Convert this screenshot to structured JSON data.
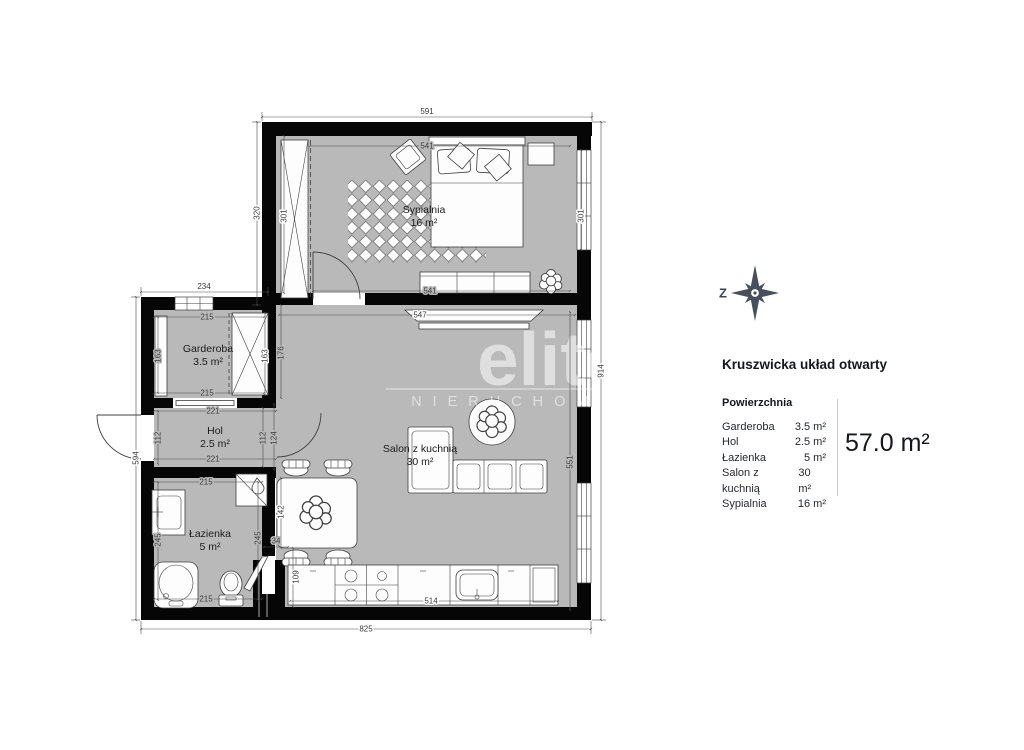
{
  "panel": {
    "compass_west": "Z",
    "title": "Kruszwicka układ otwarty",
    "areas_header": "Powierzchnia",
    "areas": [
      {
        "label": "Garderoba",
        "value": "3.5 m²"
      },
      {
        "label": "Hol",
        "value": "2.5 m²"
      },
      {
        "label": "Łazienka",
        "value": "5 m²"
      },
      {
        "label": "Salon z kuchnią",
        "value": "30 m²"
      },
      {
        "label": "Sypialnia",
        "value": "16 m²"
      }
    ],
    "total_area": "57.0 m²"
  },
  "watermark": {
    "brand": "elite",
    "subtitle": "NIERUCHOMOŚCI"
  },
  "rooms": {
    "sypialnia": {
      "name": "Sypialnia",
      "area": "16 m²"
    },
    "garderoba": {
      "name": "Garderoba",
      "area": "3.5 m²"
    },
    "hol": {
      "name": "Hol",
      "area": "2.5 m²"
    },
    "lazienka": {
      "name": "Łazienka",
      "area": "5 m²"
    },
    "salon": {
      "name": "Salon z kuchnią",
      "area": "30 m²"
    }
  },
  "dims": {
    "top_width": "591",
    "bedroom_inner_top": "541",
    "bedroom_inner_bottom": "541",
    "bedroom_height_outer": "320",
    "bedroom_height_inner": "301",
    "bedroom_window": "301",
    "right_height": "914",
    "salon_windows": "551",
    "garderoba_block_width": "234",
    "garderoba_width_top": "215",
    "garderoba_width_bottom": "215",
    "garderoba_height_left": "163",
    "garderoba_height_right": "163",
    "salon_left_niche": "176",
    "left_height": "594",
    "hol_width_top": "221",
    "hol_width_bottom": "221",
    "hol_height_left": "112",
    "hol_height_right": "112",
    "hol_height_right2": "124",
    "bath_width_top": "215",
    "bath_width_bottom": "215",
    "bath_height_left": "245",
    "bath_height_right": "245",
    "shaft_width": "34",
    "shaft_height": "109",
    "dining_table": "142",
    "salon_width_top": "547",
    "kitchen_counter": "514",
    "bottom_width": "825"
  },
  "colors": {
    "floor": "#b9b9b9",
    "wall": "#060606",
    "compass": "#47505c",
    "dim_text": "#3b3b3b",
    "watermark": "#ffffff"
  }
}
